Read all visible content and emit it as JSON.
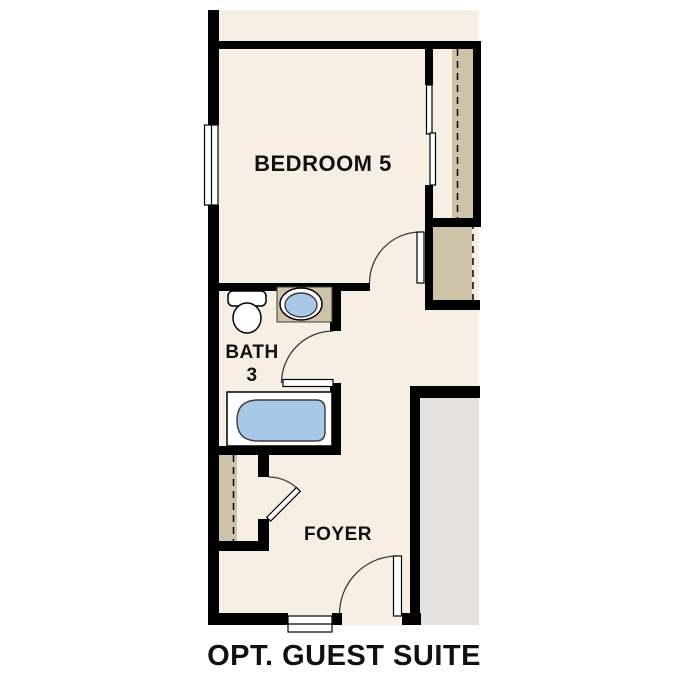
{
  "plan": {
    "caption": "OPT. GUEST SUITE",
    "rooms": {
      "bedroom": {
        "label": "BEDROOM 5"
      },
      "bath": {
        "label_line1": "BATH",
        "label_line2": "3"
      },
      "foyer": {
        "label": "FOYER"
      }
    },
    "fixtures": [
      "toilet",
      "sink",
      "bathtub"
    ],
    "features": [
      "bedroom-window",
      "bypass-closet-doors",
      "closet-dashed-openings",
      "swing-doors",
      "entry-window",
      "garage-slab"
    ]
  },
  "colors": {
    "floor": "#f7efe4",
    "closet_tan": "#cec2a9",
    "garage_gray": "#e3e2e0",
    "tub_blue": "#a9c7e6",
    "wall": "#000000",
    "line": "#3c3c3c",
    "fixture_white": "#ffffff",
    "background": "#ffffff"
  }
}
